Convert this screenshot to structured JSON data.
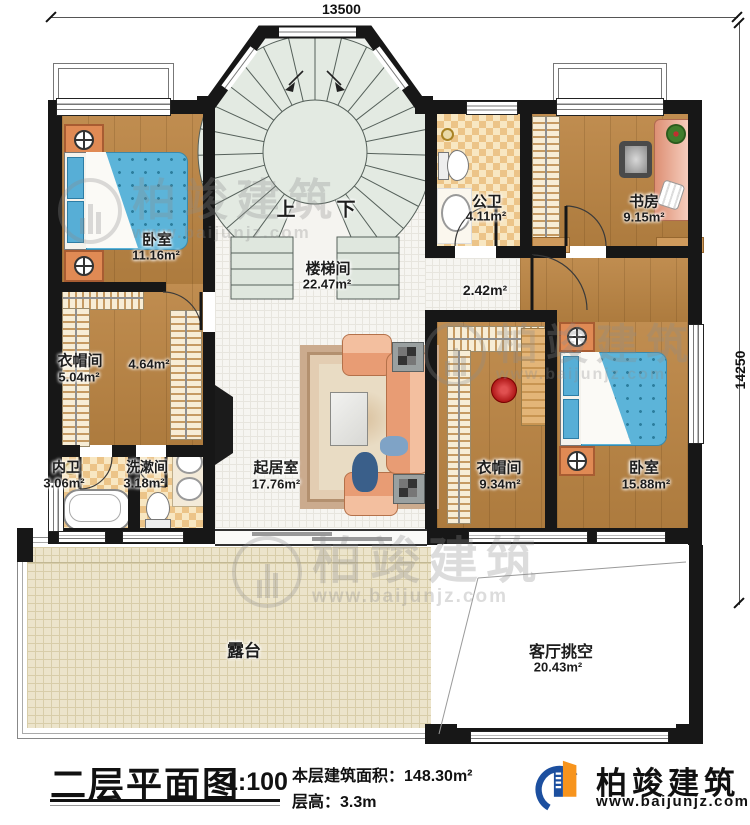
{
  "dimensions": {
    "width": "13500",
    "height": "14250"
  },
  "rooms": {
    "bedroom1": {
      "name": "卧室",
      "area": "11.16m²"
    },
    "cloak1": {
      "name": "衣帽间",
      "area": "5.04m²",
      "sub_area": "4.64m²"
    },
    "inner_bath": {
      "name": "内卫",
      "area": "3.06m²"
    },
    "washroom": {
      "name": "洗漱间",
      "area": "3.18m²"
    },
    "stairwell": {
      "name": "楼梯间",
      "area": "22.47m²",
      "up": "上",
      "down": "下"
    },
    "living": {
      "name": "起居室",
      "area": "17.76m²"
    },
    "public_bath": {
      "name": "公卫",
      "area": "4.11m²"
    },
    "study": {
      "name": "书房",
      "area": "9.15m²"
    },
    "hallway": {
      "area": "2.42m²"
    },
    "cloak2": {
      "name": "衣帽间",
      "area": "9.34m²"
    },
    "bedroom2": {
      "name": "卧室",
      "area": "15.88m²"
    },
    "terrace": {
      "name": "露台"
    },
    "void": {
      "name": "客厅挑空",
      "area": "20.43m²"
    }
  },
  "titleblock": {
    "title": "二层平面图",
    "scale": "1:100",
    "area_label": "本层建筑面积：",
    "area_value": "148.30m²",
    "floor_height_label": "层高：",
    "floor_height_value": "3.3m"
  },
  "logo": {
    "brand": "柏竣建筑",
    "url": "www.baijunjz.com"
  },
  "watermark": {
    "brand": "柏竣建筑",
    "url": "www.baijunjz.com"
  },
  "colors": {
    "accent_blue": "#1c4f9f",
    "accent_orange": "#f7941d",
    "wall": "#171717"
  }
}
